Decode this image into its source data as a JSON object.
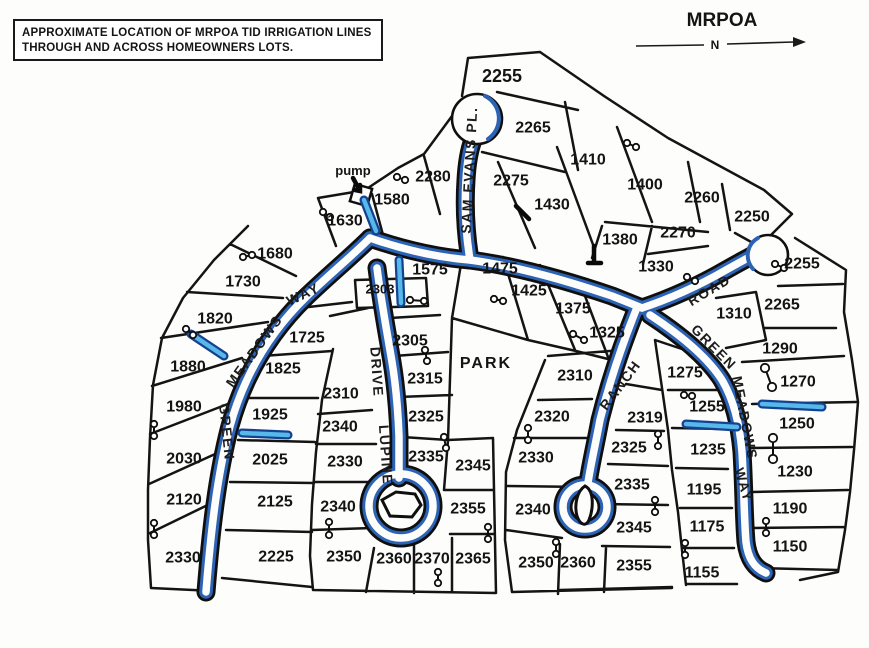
{
  "note_box": {
    "line1": "APPROXIMATE LOCATION  OF MRPOA TID IRRIGATION LINES",
    "line2": "THROUGH AND ACROSS HOMEOWNERS LOTS."
  },
  "header": {
    "map_title": "MRPOA",
    "north_label": "N"
  },
  "labels": {
    "pump": "pump",
    "park": "PARK"
  },
  "colors": {
    "ink": "#141414",
    "irrigation_blue": "#2c63b5",
    "lateral_dark": "#15418e",
    "lateral_light": "#56b9e9",
    "paper": "#fdfdfb"
  },
  "map": {
    "lots": [
      {
        "t": "2280",
        "x": 433,
        "y": 177
      },
      {
        "t": "1580",
        "x": 392,
        "y": 200
      },
      {
        "t": "1630",
        "x": 345,
        "y": 221
      },
      {
        "t": "2255",
        "x": 502,
        "y": 76,
        "s": 18
      },
      {
        "t": "2265",
        "x": 533,
        "y": 128
      },
      {
        "t": "2275",
        "x": 511,
        "y": 181
      },
      {
        "t": "1430",
        "x": 552,
        "y": 205
      },
      {
        "t": "1410",
        "x": 588,
        "y": 160
      },
      {
        "t": "1400",
        "x": 645,
        "y": 185
      },
      {
        "t": "2260",
        "x": 702,
        "y": 198
      },
      {
        "t": "2250",
        "x": 752,
        "y": 217
      },
      {
        "t": "1380",
        "x": 620,
        "y": 240
      },
      {
        "t": "2270",
        "x": 678,
        "y": 233
      },
      {
        "t": "1330",
        "x": 656,
        "y": 267
      },
      {
        "t": "1575",
        "x": 430,
        "y": 270
      },
      {
        "t": "2303",
        "x": 380,
        "y": 289,
        "s": 13
      },
      {
        "t": "1475",
        "x": 500,
        "y": 269
      },
      {
        "t": "1425",
        "x": 529,
        "y": 291
      },
      {
        "t": "1375",
        "x": 573,
        "y": 309
      },
      {
        "t": "1325",
        "x": 607,
        "y": 333
      },
      {
        "t": "1680",
        "x": 275,
        "y": 254
      },
      {
        "t": "1730",
        "x": 243,
        "y": 282
      },
      {
        "t": "1820",
        "x": 215,
        "y": 319
      },
      {
        "t": "1880",
        "x": 188,
        "y": 367
      },
      {
        "t": "1980",
        "x": 184,
        "y": 407
      },
      {
        "t": "2030",
        "x": 184,
        "y": 459
      },
      {
        "t": "2120",
        "x": 184,
        "y": 500
      },
      {
        "t": "2330",
        "x": 183,
        "y": 558
      },
      {
        "t": "1725",
        "x": 307,
        "y": 338
      },
      {
        "t": "1825",
        "x": 283,
        "y": 369
      },
      {
        "t": "1925",
        "x": 270,
        "y": 415
      },
      {
        "t": "2025",
        "x": 270,
        "y": 460
      },
      {
        "t": "2125",
        "x": 275,
        "y": 502
      },
      {
        "t": "2225",
        "x": 276,
        "y": 557
      },
      {
        "t": "2310",
        "x": 341,
        "y": 394
      },
      {
        "t": "2340",
        "x": 340,
        "y": 427
      },
      {
        "t": "2330",
        "x": 345,
        "y": 462
      },
      {
        "t": "2340",
        "x": 338,
        "y": 507
      },
      {
        "t": "2350",
        "x": 344,
        "y": 557
      },
      {
        "t": "2305",
        "x": 410,
        "y": 341
      },
      {
        "t": "2315",
        "x": 425,
        "y": 379
      },
      {
        "t": "2325",
        "x": 426,
        "y": 417
      },
      {
        "t": "2335",
        "x": 426,
        "y": 457
      },
      {
        "t": "2345",
        "x": 473,
        "y": 466
      },
      {
        "t": "2355",
        "x": 468,
        "y": 509
      },
      {
        "t": "2360",
        "x": 394,
        "y": 559
      },
      {
        "t": "2370",
        "x": 432,
        "y": 559
      },
      {
        "t": "2365",
        "x": 473,
        "y": 559
      },
      {
        "t": "2310",
        "x": 575,
        "y": 376
      },
      {
        "t": "2320",
        "x": 552,
        "y": 417
      },
      {
        "t": "2330",
        "x": 536,
        "y": 458
      },
      {
        "t": "2340",
        "x": 533,
        "y": 510
      },
      {
        "t": "2350",
        "x": 536,
        "y": 563
      },
      {
        "t": "2360",
        "x": 578,
        "y": 563
      },
      {
        "t": "2319",
        "x": 645,
        "y": 418
      },
      {
        "t": "2325",
        "x": 629,
        "y": 448
      },
      {
        "t": "2335",
        "x": 632,
        "y": 485
      },
      {
        "t": "2345",
        "x": 634,
        "y": 528
      },
      {
        "t": "2355",
        "x": 634,
        "y": 566
      },
      {
        "t": "1275",
        "x": 685,
        "y": 373
      },
      {
        "t": "1255",
        "x": 707,
        "y": 407
      },
      {
        "t": "1235",
        "x": 708,
        "y": 450
      },
      {
        "t": "1195",
        "x": 704,
        "y": 490
      },
      {
        "t": "1175",
        "x": 707,
        "y": 527
      },
      {
        "t": "1155",
        "x": 702,
        "y": 573
      },
      {
        "t": "1310",
        "x": 734,
        "y": 314
      },
      {
        "t": "1290",
        "x": 780,
        "y": 349
      },
      {
        "t": "1270",
        "x": 798,
        "y": 382
      },
      {
        "t": "1250",
        "x": 797,
        "y": 424
      },
      {
        "t": "1230",
        "x": 795,
        "y": 472
      },
      {
        "t": "1190",
        "x": 790,
        "y": 509
      },
      {
        "t": "1150",
        "x": 790,
        "y": 547
      },
      {
        "t": "2255",
        "x": 802,
        "y": 264
      },
      {
        "t": "2265",
        "x": 782,
        "y": 305
      }
    ],
    "streets": [
      {
        "name": "SAM EVANS PL.",
        "x": 469,
        "y": 170,
        "r": -87,
        "s": 14
      },
      {
        "name": "GREEN",
        "x": 227,
        "y": 432,
        "r": 84,
        "s": 14
      },
      {
        "name": "MEADOWS",
        "x": 254,
        "y": 351,
        "r": -54,
        "s": 14
      },
      {
        "name": "WAY",
        "x": 303,
        "y": 294,
        "r": -25,
        "s": 14
      },
      {
        "name": "DRIVE",
        "x": 377,
        "y": 372,
        "r": 86,
        "s": 14
      },
      {
        "name": "LUPINE",
        "x": 386,
        "y": 455,
        "r": 86,
        "s": 14
      },
      {
        "name": "RANCH",
        "x": 620,
        "y": 385,
        "r": -53,
        "s": 14
      },
      {
        "name": "ROAD",
        "x": 709,
        "y": 290,
        "r": -31,
        "s": 14
      },
      {
        "name": "GREEN",
        "x": 714,
        "y": 347,
        "r": 45,
        "s": 14
      },
      {
        "name": "MEADOWS",
        "x": 745,
        "y": 418,
        "r": 79,
        "s": 14
      },
      {
        "name": "WAY",
        "x": 744,
        "y": 485,
        "r": 73,
        "s": 14
      }
    ],
    "valves": [
      [
        410,
        300,
        424,
        301
      ],
      [
        425,
        350,
        427,
        361
      ],
      [
        444,
        437,
        446,
        448
      ],
      [
        488,
        527,
        488,
        539
      ],
      [
        438,
        572,
        438,
        583
      ],
      [
        154,
        424,
        154,
        436
      ],
      [
        154,
        523,
        154,
        535
      ],
      [
        329,
        522,
        329,
        535
      ],
      [
        243,
        257,
        252,
        255
      ],
      [
        186,
        329,
        193,
        335
      ],
      [
        627,
        143,
        636,
        147
      ],
      [
        687,
        277,
        695,
        281
      ],
      [
        573,
        334,
        584,
        340
      ],
      [
        494,
        299,
        503,
        301
      ],
      [
        775,
        264,
        784,
        268
      ],
      [
        684,
        395,
        692,
        396
      ],
      [
        765,
        368,
        772,
        387,
        4.2
      ],
      [
        773,
        438,
        773,
        459,
        4.2
      ],
      [
        766,
        521,
        766,
        533
      ],
      [
        685,
        543,
        685,
        555
      ],
      [
        528,
        428,
        528,
        440
      ],
      [
        658,
        434,
        658,
        446
      ],
      [
        655,
        500,
        655,
        512
      ],
      [
        556,
        542,
        556,
        554
      ],
      [
        323,
        212,
        330,
        217
      ],
      [
        397,
        177,
        405,
        180
      ]
    ],
    "laterals": [
      [
        364,
        200,
        376,
        231
      ],
      [
        399,
        260,
        401,
        303
      ],
      [
        191,
        334,
        224,
        356
      ],
      [
        242,
        433,
        288,
        435
      ],
      [
        686,
        424,
        737,
        427
      ],
      [
        762,
        404,
        822,
        407
      ]
    ],
    "service_marks": [
      [
        516,
        206,
        529,
        219
      ],
      [
        594,
        246,
        594,
        262
      ],
      [
        588,
        263,
        601,
        263
      ]
    ]
  }
}
